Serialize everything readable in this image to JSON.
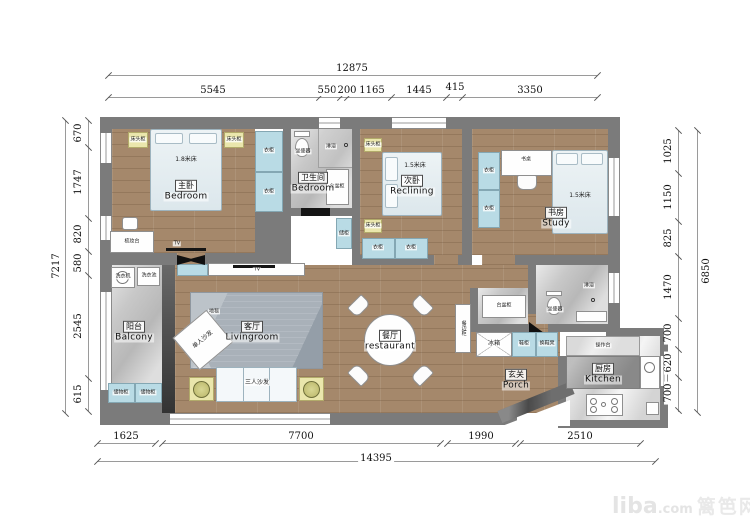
{
  "watermark": {
    "brand": "liba",
    "domain": ".com",
    "site": "篱笆网"
  },
  "colors": {
    "wall": "#7b7b7b",
    "wood_floor": "#a5886b",
    "cabinet_blue": "#b9dbe5",
    "cabinet_yellow": "#eae6ac",
    "tile": "#c8c8c8"
  },
  "dims": {
    "top": {
      "total": "12875",
      "segs": [
        "5545",
        "550",
        "200",
        "1165",
        "1445",
        "415",
        "3350"
      ]
    },
    "bottom": {
      "total": "14395",
      "segs": [
        "1625",
        "7700",
        "1990",
        "2510"
      ]
    },
    "left": {
      "total": "7217",
      "segs": [
        "670",
        "1747",
        "820",
        "580",
        "2545",
        "615"
      ]
    },
    "right": {
      "total": "6850",
      "segs": [
        "1025",
        "1150",
        "825",
        "1470",
        "700",
        "620",
        "700"
      ]
    }
  },
  "rooms": {
    "master": {
      "cn": "主卧",
      "en": "Bedroom",
      "bed": "1.8米床"
    },
    "bath1": {
      "cn": "卫生间",
      "en": "Bedroom"
    },
    "second": {
      "cn": "次卧",
      "en": "Reclining",
      "bed": "1.5米床"
    },
    "study": {
      "cn": "书房",
      "en": "Study",
      "bed": "1.5米床"
    },
    "balcony": {
      "cn": "阳台",
      "en": "Balcony"
    },
    "living": {
      "cn": "客厅",
      "en": "Livingroom"
    },
    "dining": {
      "cn": "餐厅",
      "en": "restaurant"
    },
    "porch": {
      "cn": "玄关",
      "en": "Porch"
    },
    "kitchen": {
      "cn": "厨房",
      "en": "Kitchen"
    }
  },
  "furniture": {
    "nightstand": "床头柜",
    "wardrobe": "衣柜",
    "dresser": "梳妆台",
    "tv": "TV",
    "toilet": "坐便器",
    "shower": "淋浴",
    "basin": "台盆柜",
    "storage_small": "储柜",
    "desk": "书桌",
    "washer": "洗衣机",
    "laundry_sink": "洗衣池",
    "storage": "储物柜",
    "rug": "地毯",
    "single_sofa": "单人沙发",
    "sofa3": "三人沙发",
    "sideboard": "餐边柜",
    "fridge": "冰箱",
    "shoe_cabinet": "鞋柜",
    "shoe_bench": "换鞋凳",
    "counter": "操作台"
  }
}
